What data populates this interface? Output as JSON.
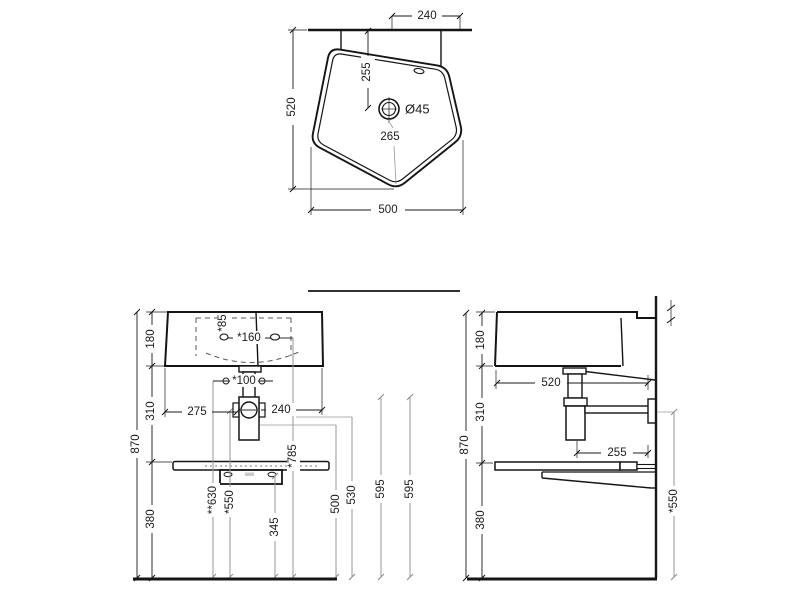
{
  "top_view": {
    "dims": {
      "hanger_spacing": "240",
      "depth": "520",
      "width": "500",
      "drain_to_wall": "255",
      "drain_diameter": "Ø45",
      "drain_to_front": "265"
    }
  },
  "front_view": {
    "dims": {
      "rim_height": "180",
      "rim_to_shelf": "310",
      "shelf_to_floor": "380",
      "total_height": "870",
      "left_to_drain": "275",
      "drain_to_right": "240",
      "tap_hole_offset": "*85",
      "tap_hole_spacing": "*160",
      "fixing_spacing": "*100",
      "fixing_height": "**630",
      "trap_center_height": "*550",
      "bracket_height": "345",
      "tap_hole_height": "*785",
      "outlet_height_a": "500",
      "outlet_height_b": "530",
      "ref_height_a": "595",
      "ref_height_b": "595"
    }
  },
  "side_view": {
    "dims": {
      "rim_height": "180",
      "rim_to_shelf": "310",
      "shelf_to_floor": "380",
      "total_height": "870",
      "depth": "520",
      "trap_to_wall": "255",
      "outlet_height": "*550"
    }
  }
}
